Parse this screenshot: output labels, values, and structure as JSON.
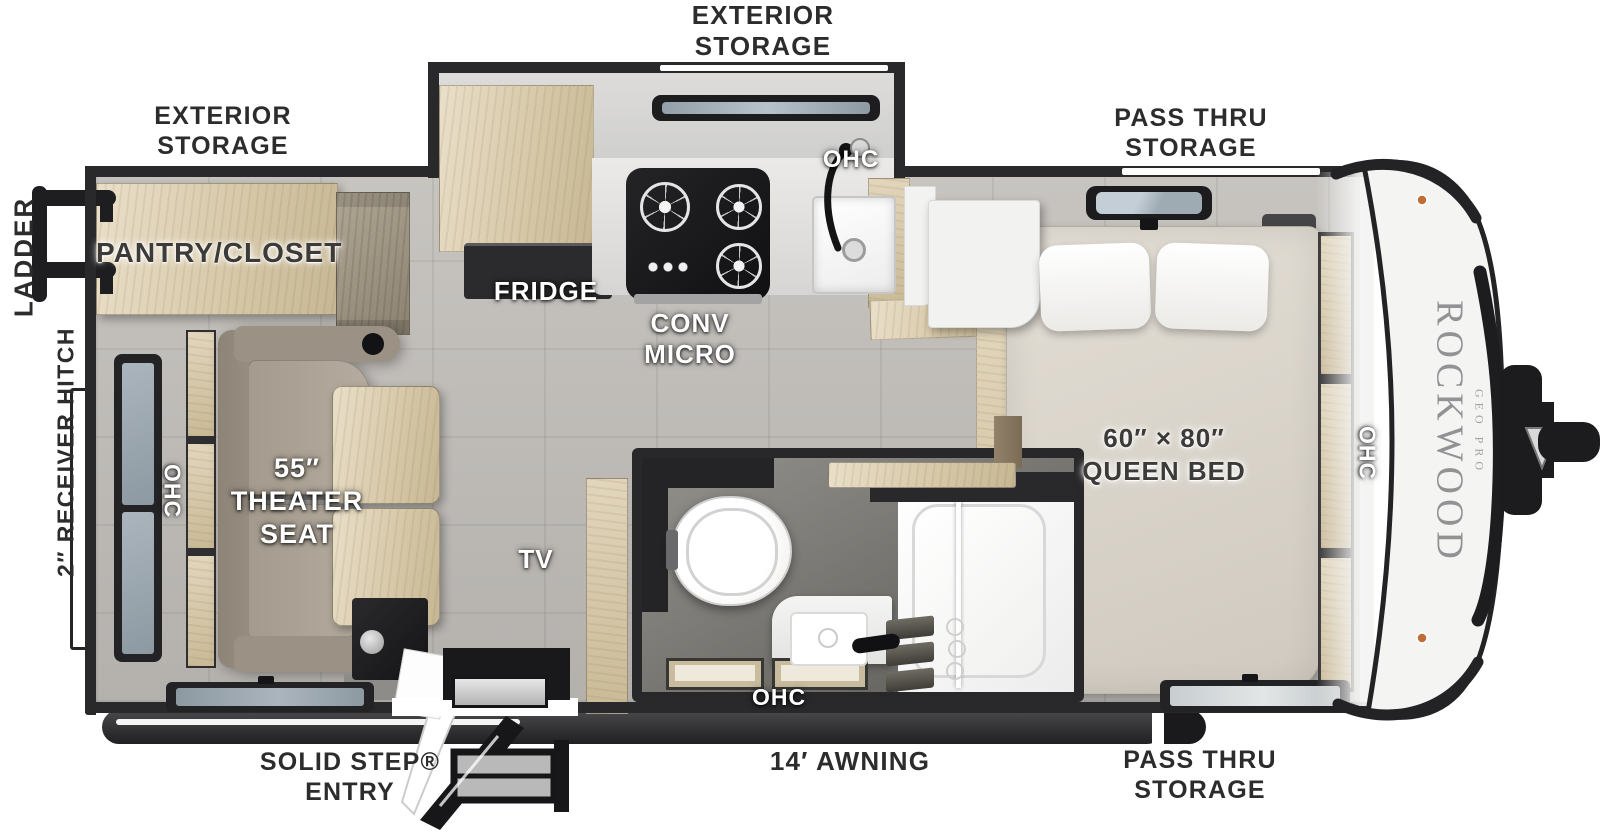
{
  "labels": {
    "exterior_storage": "EXTERIOR STORAGE",
    "pass_thru_storage": "PASS THRU STORAGE",
    "ladder": "LADDER",
    "receiver_hitch": "2″ RECEIVER HITCH",
    "solid_step_entry": "SOLID STEP® ENTRY",
    "awning": "14′ AWNING",
    "pantry_closet": "PANTRY/CLOSET",
    "fridge": "FRIDGE",
    "conv_micro": "CONV MICRO",
    "ohc": "OHC",
    "theater_seat": "55″ THEATER SEAT",
    "tv": "TV",
    "queen_bed": "60″ × 80″ QUEEN BED"
  },
  "branding": {
    "make": "ROCKWOOD",
    "series": "GEO PRO"
  },
  "colors": {
    "wall": "#29282b",
    "floor_tile": "#c0bdb9",
    "wood": "#d7c9a9",
    "bed": "#ddd7cd",
    "cap": "#f4f4f3",
    "label_dark": "#2c2c2d",
    "label_light": "#ffffff"
  }
}
